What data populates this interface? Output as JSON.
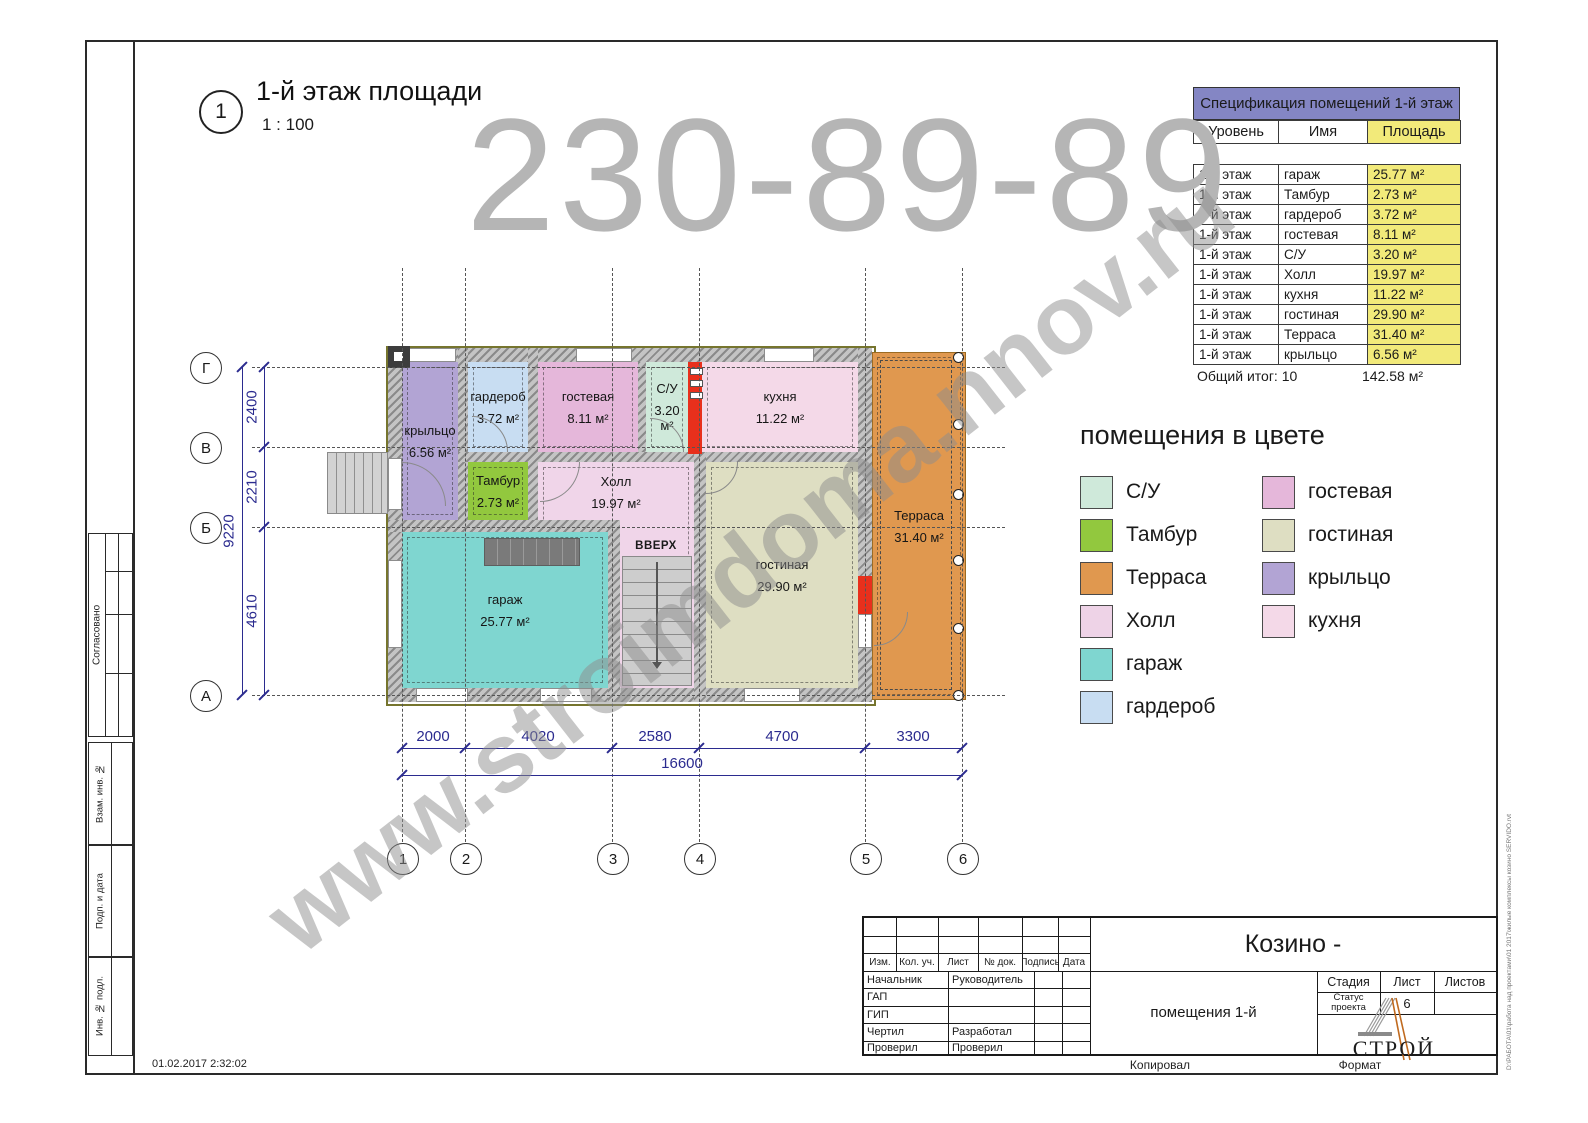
{
  "view": {
    "number": "1",
    "title": "1-й этаж площади",
    "scale": "1 : 100"
  },
  "watermark": {
    "phone": "230-89-89",
    "site": "www.stroimdoma.nnov.ru"
  },
  "spec": {
    "title": "Спецификация помещений 1-й этаж",
    "columns": [
      "Уровень",
      "Имя",
      "Площадь"
    ],
    "rows": [
      [
        "1-й этаж",
        "гараж",
        "25.77 м²"
      ],
      [
        "1-й этаж",
        "Тамбур",
        "2.73 м²"
      ],
      [
        "1-й этаж",
        "гардероб",
        "3.72 м²"
      ],
      [
        "1-й этаж",
        "гостевая",
        "8.11 м²"
      ],
      [
        "1-й этаж",
        "С/У",
        "3.20 м²"
      ],
      [
        "1-й этаж",
        "Холл",
        "19.97 м²"
      ],
      [
        "1-й этаж",
        "кухня",
        "11.22 м²"
      ],
      [
        "1-й этаж",
        "гостиная",
        "29.90 м²"
      ],
      [
        "1-й этаж",
        "Терраса",
        "31.40 м²"
      ],
      [
        "1-й этаж",
        "крыльцо",
        "6.56 м²"
      ]
    ],
    "total_label": "Общий итог: 10",
    "total_value": "142.58 м²"
  },
  "legend": {
    "title": "помещения в цвете",
    "items": [
      {
        "label": "С/У",
        "color": "#cfe9da"
      },
      {
        "label": "Тамбур",
        "color": "#92c83e"
      },
      {
        "label": "Терраса",
        "color": "#e0984f"
      },
      {
        "label": "Холл",
        "color": "#eed3e7"
      },
      {
        "label": "гараж",
        "color": "#7fd6d0"
      },
      {
        "label": "гардероб",
        "color": "#c8ddf2"
      },
      {
        "label": "гостевая",
        "color": "#e5b7da"
      },
      {
        "label": "гостиная",
        "color": "#dedec2"
      },
      {
        "label": "крыльцо",
        "color": "#b2a4d4"
      },
      {
        "label": "кухня",
        "color": "#f4d9e8"
      }
    ]
  },
  "plan": {
    "rooms": {
      "kryltso": {
        "label": "крыльцо",
        "area": "6.56 м²",
        "color": "#b2a4d4"
      },
      "garderob": {
        "label": "гардероб",
        "area": "3.72 м²",
        "color": "#c8ddf2"
      },
      "gostevaya": {
        "label": "гостевая",
        "area": "8.11 м²",
        "color": "#e5b7da"
      },
      "su": {
        "label": "С/У",
        "area": "3.20 м²",
        "color": "#cfe9da"
      },
      "kuhnya": {
        "label": "кухня",
        "area": "11.22 м²",
        "color": "#f4d9e8"
      },
      "tambur": {
        "label": "Тамбур",
        "area": "2.73 м²",
        "color": "#92c83e"
      },
      "holl": {
        "label": "Холл",
        "area": "19.97 м²",
        "color": "#f0d5e9"
      },
      "garazh": {
        "label": "гараж",
        "area": "25.77 м²",
        "color": "#7fd6d0"
      },
      "gostinaya": {
        "label": "гостиная",
        "area": "29.90 м²",
        "color": "#dedec2"
      },
      "terrasa": {
        "label": "Терраса",
        "area": "31.40 м²",
        "color": "#e0984f"
      }
    },
    "stairs_label": "ВВЕРХ",
    "axes": {
      "cols": [
        "1",
        "2",
        "3",
        "4",
        "5",
        "6"
      ],
      "rows": [
        "Г",
        "В",
        "Б",
        "А"
      ]
    },
    "dims": {
      "bottom": [
        "2000",
        "4020",
        "2580",
        "4700",
        "3300"
      ],
      "bottom_total": "16600",
      "left": [
        "2400",
        "2210",
        "4610"
      ],
      "left_total": "9220"
    }
  },
  "titleblock": {
    "project": "Козино -",
    "sheet_name": "помещения 1-й",
    "rev_cols": [
      "Изм.",
      "Кол. уч.",
      "Лист",
      "№ док.",
      "Подпись",
      "Дата"
    ],
    "roles": [
      [
        "Начальник",
        "Руководитель"
      ],
      [
        "ГАП",
        ""
      ],
      [
        "ГИП",
        ""
      ],
      [
        "Чертил",
        "Разработал"
      ],
      [
        "Проверил",
        "Проверил"
      ]
    ],
    "stage_label": "Стадия",
    "list_label": "Лист",
    "lists_label": "Листов",
    "stage_value": "Статус проекта",
    "list_value": "6",
    "logo_text": "СТРОЙ"
  },
  "margins": {
    "left_labels": [
      "Согласовано",
      "Взам. инв. №",
      "Подп. и дата",
      "Инв. № подл."
    ],
    "footer_copied": "Копировал",
    "footer_format": "Формат",
    "timestamp": "01.02.2017 2:32:02",
    "file_path": "D:\\РАБОТА\\01\\работа над проектами\\01 2017\\жилые комплексы козино SERVIDO.rvt"
  }
}
